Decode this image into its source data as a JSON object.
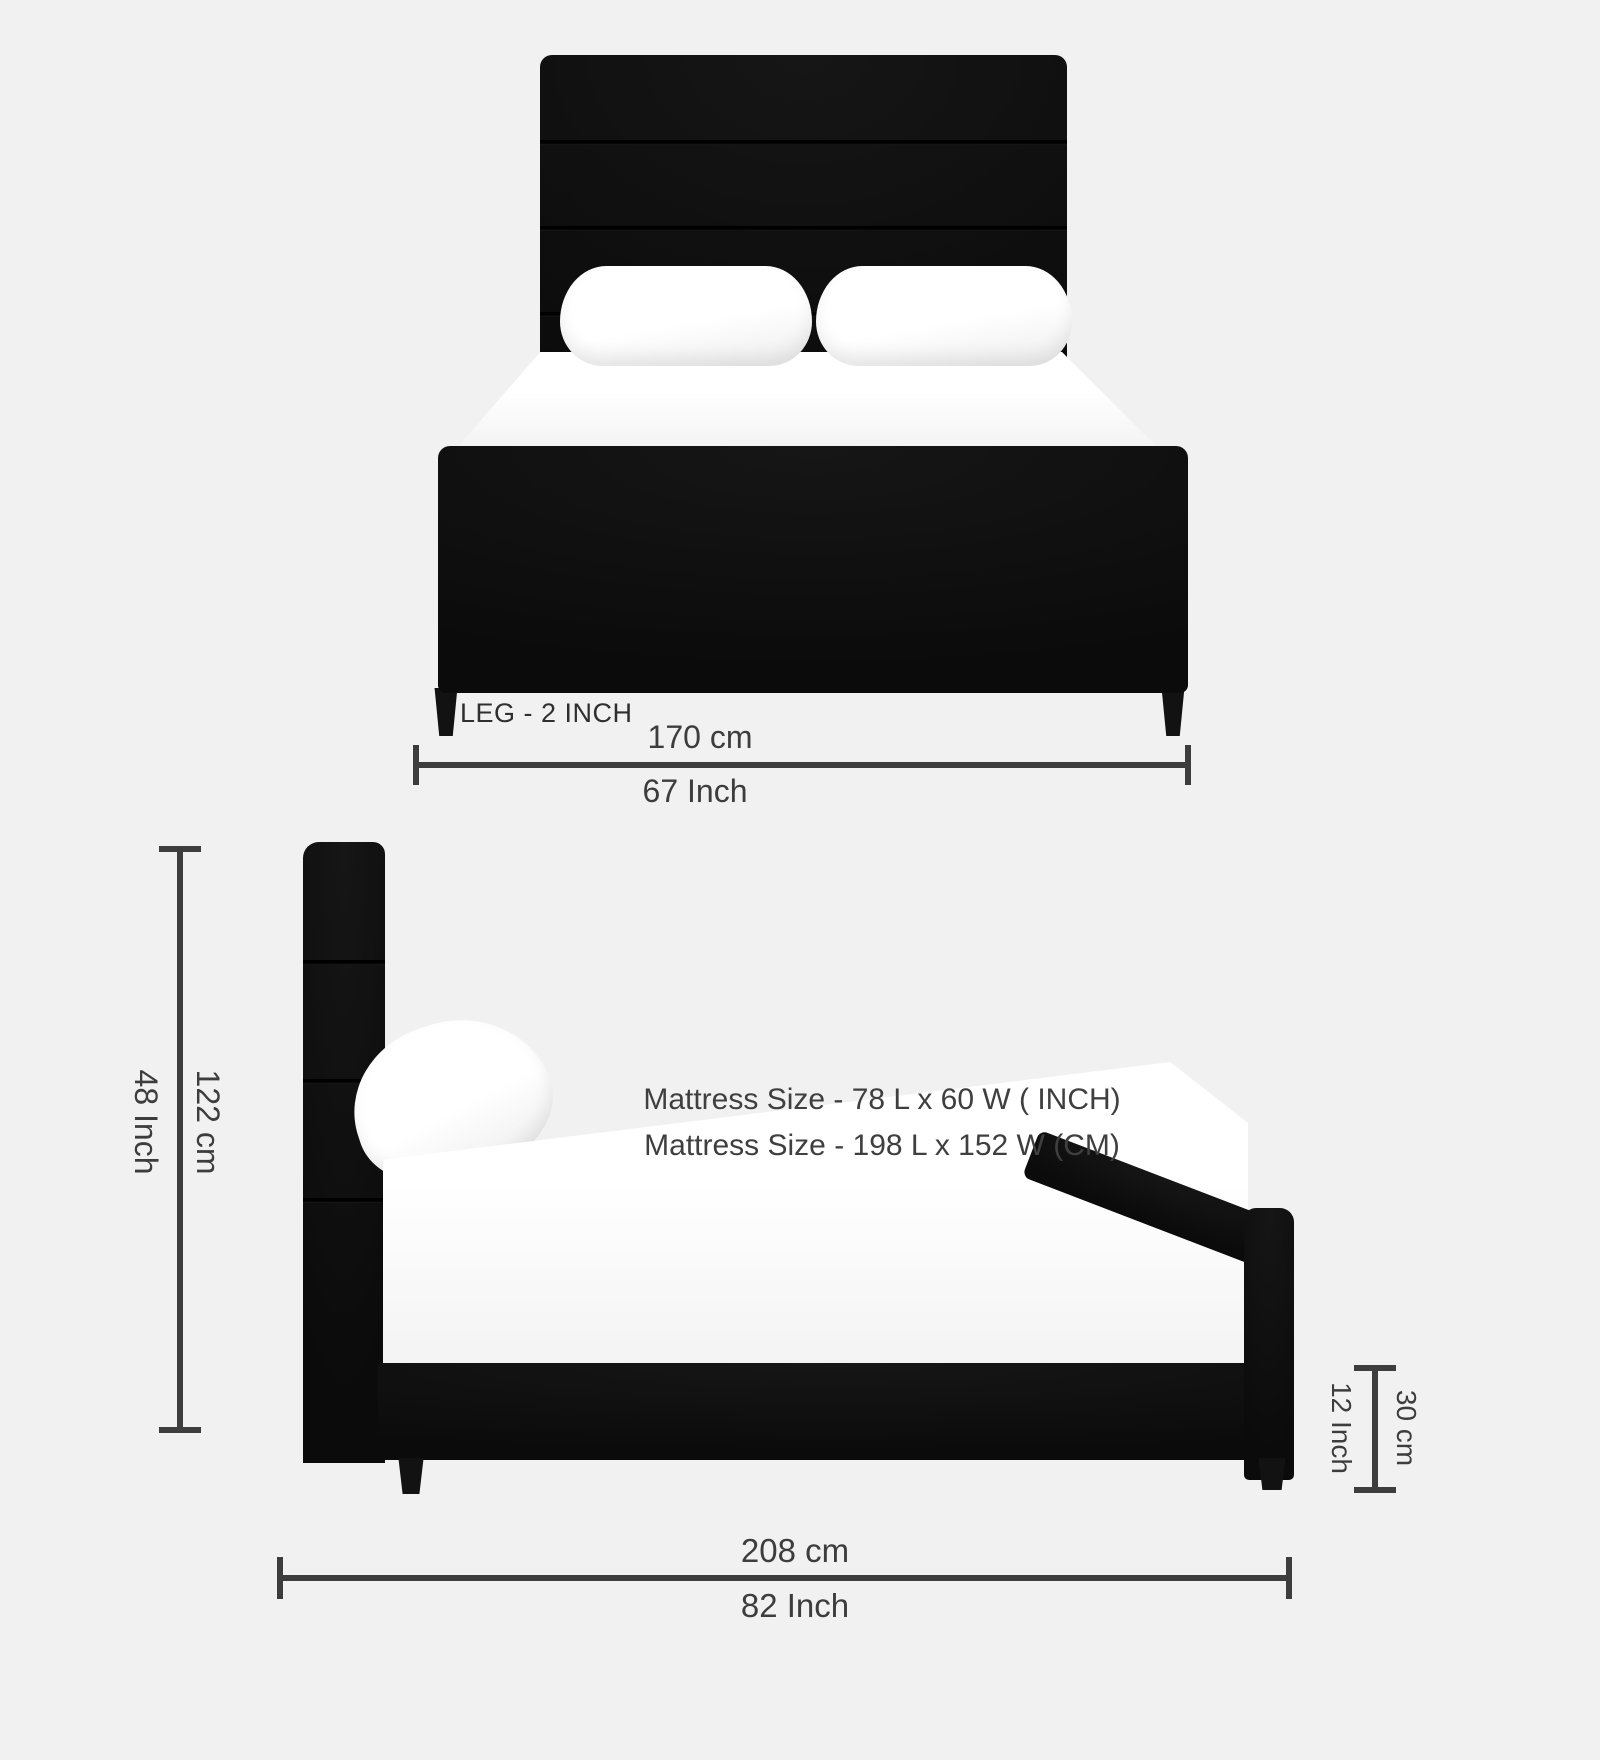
{
  "colors": {
    "background": "#f1f1f1",
    "bed": "#0e0e0e",
    "pillow_mattress": "#ffffff",
    "dimension": "#3d3d3d"
  },
  "front_view": {
    "leg_label": "LEG - 2 INCH",
    "width_dimension": {
      "cm": "170 cm",
      "inch": "67 Inch"
    }
  },
  "side_view": {
    "height_dimension": {
      "cm": "122 cm",
      "inch": "48 Inch"
    },
    "mattress_note": {
      "line_inch": "Mattress Size - 78 L x 60 W ( INCH)",
      "line_cm": "Mattress Size - 198 L x 152 W (CM)"
    },
    "base_height_dimension": {
      "cm": "30 cm",
      "inch": "12 Inch"
    },
    "length_dimension": {
      "cm": "208 cm",
      "inch": "82 Inch"
    }
  }
}
